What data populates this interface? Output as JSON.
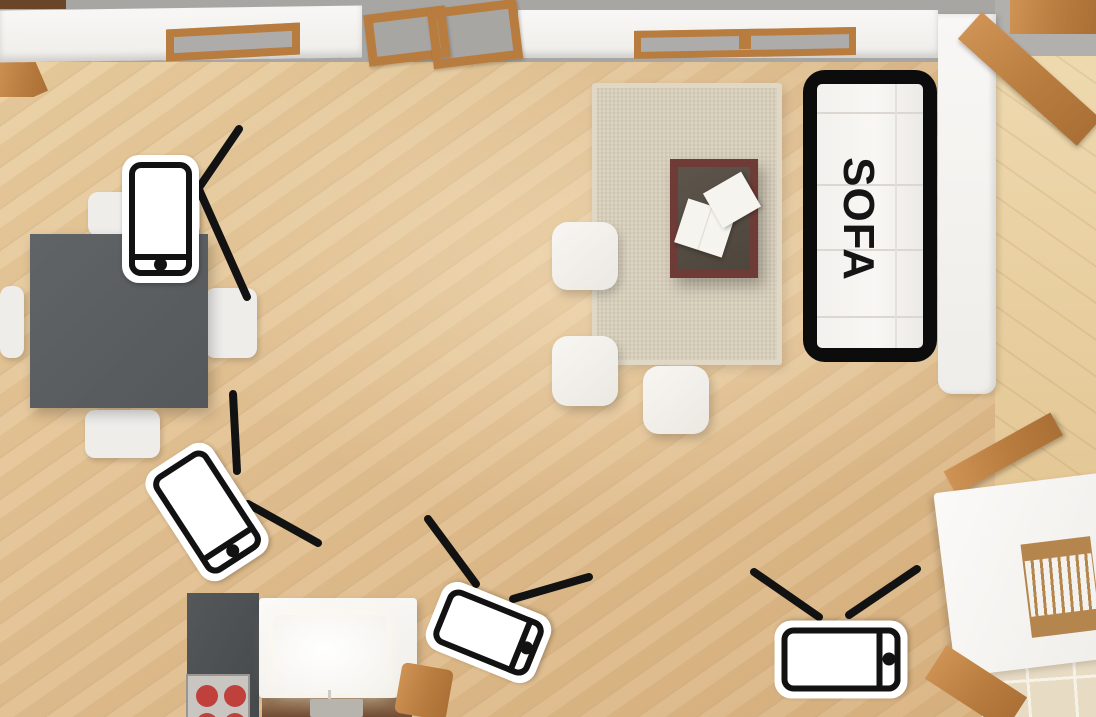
{
  "sofa": {
    "label": "SOFA"
  },
  "colors": {
    "icon_black": "#121212",
    "floor_wood": "#e2c091",
    "floor_right_room": "#e8d2a8",
    "wall_white": "#f5f4f1",
    "outside_gray": "#a7a6a3",
    "furniture_wood": "#b97c3f",
    "dining_table_gray": "#585c5e",
    "rug_beige": "#d8cfbb",
    "coffee_table_maroon": "#6e3b37",
    "burner_red": "#c0403c",
    "signal_line": "#121212"
  },
  "devices": [
    {
      "name": "smartphone-dining-table-icon",
      "type": "smartphone",
      "cx": 160,
      "cy": 219,
      "w": 77,
      "h": 128,
      "rotation": 0
    },
    {
      "name": "smartphone-kitchen-floor-icon",
      "type": "smartphone",
      "cx": 207,
      "cy": 512,
      "w": 78,
      "h": 130,
      "rotation": -33
    },
    {
      "name": "tv-kitchen-island-icon",
      "type": "tv",
      "cx": 488,
      "cy": 632,
      "w": 73,
      "h": 117,
      "rotation": -68
    },
    {
      "name": "tv-living-room-icon",
      "type": "tv",
      "cx": 841,
      "cy": 659,
      "w": 78,
      "h": 133,
      "rotation": -90
    }
  ],
  "signal_lines": {
    "stroke_width": 8,
    "lines": [
      {
        "x1": 239,
        "y1": 129,
        "x2": 196,
        "y2": 192
      },
      {
        "x1": 197,
        "y1": 185,
        "x2": 247,
        "y2": 297
      },
      {
        "x1": 233,
        "y1": 394,
        "x2": 237,
        "y2": 471
      },
      {
        "x1": 248,
        "y1": 504,
        "x2": 318,
        "y2": 543
      },
      {
        "x1": 428,
        "y1": 519,
        "x2": 476,
        "y2": 584
      },
      {
        "x1": 513,
        "y1": 599,
        "x2": 589,
        "y2": 577
      },
      {
        "x1": 754,
        "y1": 572,
        "x2": 819,
        "y2": 617
      },
      {
        "x1": 917,
        "y1": 569,
        "x2": 849,
        "y2": 615
      }
    ]
  }
}
